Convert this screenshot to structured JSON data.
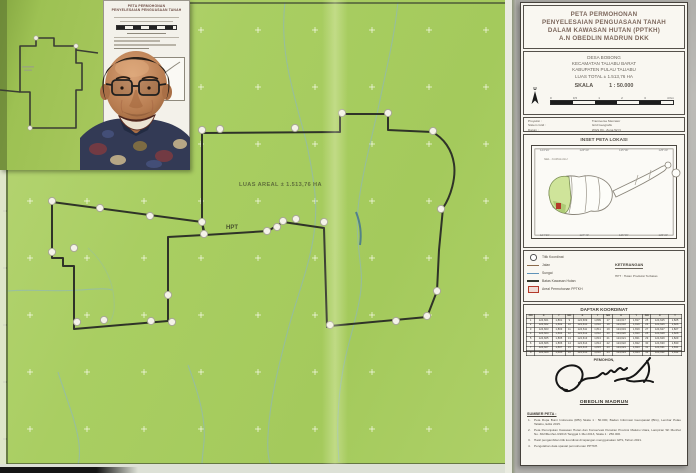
{
  "map": {
    "area_label": "LUAS AREAL ± 1.513,76 HA",
    "zone_label": "HPT"
  },
  "photo": {
    "doc_title_lines": [
      "PETA PERMOHONAN",
      "PENYELESAIAN PENGUASAAN TANAH"
    ]
  },
  "panel": {
    "title_lines": [
      "PETA PERMOHONAN",
      "PENYELESAIAN PENGUASAAN TANAH",
      "DALAM KAWASAN HUTAN (PPTKH)",
      "A.N OBEDLIN MADRUN DKK"
    ],
    "location_lines": [
      "DESA BOBONG",
      "KECAMATAN TALIABU BARAT",
      "KABUPATEN PULAU TALIABU",
      "LUAS TOTAL ± 1.513,76 HA"
    ],
    "scale_label": "SKALA",
    "scale_value": "1 : 50.000",
    "north_label": "U",
    "scalebar_ticks": [
      "0",
      "0,5",
      "1",
      "2",
      "3",
      "4 Km"
    ],
    "proj_labels": [
      "Proyeksi :",
      "Sistem Grid :",
      "Datum :"
    ],
    "proj_values": [
      "Transverse Mercator",
      "Grid Geografis",
      "WGS 84 - Zona 52 N"
    ],
    "inset": {
      "title": "INSET PETA LOKASI",
      "sea_label": "SEL. CAPALULU",
      "top_ticks": [
        "124°20'",
        "124°40'",
        "125°00'",
        "125°20'"
      ],
      "bottom_ticks": [
        "124°20'",
        "124°40'",
        "125°00'",
        "125°20'"
      ]
    },
    "legend": {
      "items": [
        {
          "icon": "point",
          "label": "Titik Koordinat"
        },
        {
          "icon": "road",
          "label": "Jalan"
        },
        {
          "icon": "river",
          "label": "Sungai"
        },
        {
          "icon": "boundary",
          "label": "Batas Kawasan Hutan"
        },
        {
          "icon": "area",
          "label": "Areal Permohonan PPTKH"
        }
      ],
      "keterangan_title": "KETERANGAN",
      "keterangan_line": "HPT : Hutan Produksi Terbatas"
    },
    "table": {
      "title": "DAFTAR KOORDINAT",
      "header": [
        "NO",
        "X",
        "Y",
        "NO",
        "X",
        "Y",
        "NO",
        "X",
        "Y",
        "NO",
        "X",
        "Y"
      ],
      "rows": [
        [
          "1",
          "124,601",
          "1,801",
          "9",
          "124,609",
          "1,809",
          "17",
          "124,617",
          "1,817",
          "25",
          "124,625",
          "1,825"
        ],
        [
          "2",
          "124,602",
          "1,802",
          "10",
          "124,610",
          "1,810",
          "18",
          "124,618",
          "1,818",
          "26",
          "124,626",
          "1,826"
        ],
        [
          "3",
          "124,603",
          "1,803",
          "11",
          "124,611",
          "1,811",
          "19",
          "124,619",
          "1,819",
          "27",
          "124,627",
          "1,827"
        ],
        [
          "4",
          "124,604",
          "1,804",
          "12",
          "124,612",
          "1,812",
          "20",
          "124,620",
          "1,820",
          "28",
          "124,628",
          "1,828"
        ],
        [
          "5",
          "124,605",
          "1,805",
          "13",
          "124,613",
          "1,813",
          "21",
          "124,621",
          "1,821",
          "29",
          "124,629",
          "1,829"
        ],
        [
          "6",
          "124,606",
          "1,806",
          "14",
          "124,614",
          "1,814",
          "22",
          "124,622",
          "1,822",
          "30",
          "124,630",
          "1,830"
        ],
        [
          "7",
          "124,607",
          "1,807",
          "15",
          "124,615",
          "1,815",
          "23",
          "124,623",
          "1,823",
          "31",
          "124,631",
          "1,831"
        ],
        [
          "8",
          "124,608",
          "1,808",
          "16",
          "124,616",
          "1,816",
          "24",
          "124,624",
          "1,824",
          "32",
          "124,632",
          "1,832"
        ]
      ]
    },
    "signature": {
      "role": "PEMOHON,",
      "name": "OBEDLIN MADRUN"
    },
    "notes": {
      "title": "SUMBER PETA :",
      "items": [
        "Peta Rupa Bumi Indonesia (RBI) Skala 1 : 50.000, Badan Informasi Geospasial (BIG), Lembar Pulau Taliabu, Edisi 2015.",
        "Peta Penunjukan Kawasan Hutan dan Konservasi Perairan Provinsi Maluku Utara, Lampiran SK Menhut No. 302/Menhut-II/2013 Tanggal 1 Mei 2013, Skala 1 : 250.000.",
        "Hasil pengambilan titik koordinat di lapangan menggunakan GPS, Tahun 2021.",
        "Pengolahan data spasial permohonan PPTKH."
      ]
    }
  }
}
